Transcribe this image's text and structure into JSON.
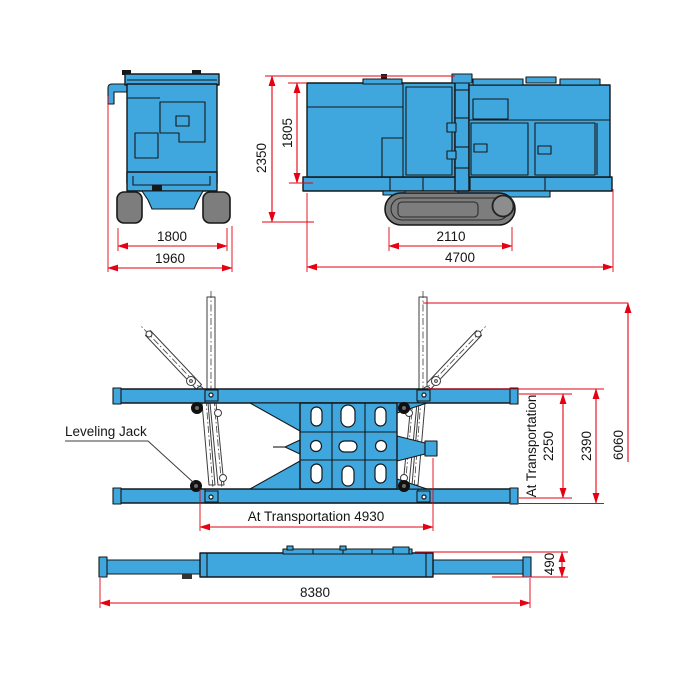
{
  "colors": {
    "machine_blue": "#3fa7dd",
    "track_gray": "#7d7d7d",
    "dim_red": "#e60012",
    "outline": "#16181a",
    "background": "#ffffff"
  },
  "front_view": {
    "dim_track_width": "1800",
    "dim_overall_width": "1960"
  },
  "side_view": {
    "dim_overall_height": "2350",
    "dim_body_height": "1805",
    "dim_track_length": "2110",
    "dim_overall_length": "4700"
  },
  "plan_view": {
    "leveling_jack_label": "Leveling Jack",
    "dim_transport_length": "At Transportation 4930",
    "dim_transport_width_line1": "At Transportation",
    "dim_transport_width_value": "2250",
    "dim_frame_width": "2390",
    "dim_outrigger_span": "6060"
  },
  "elevation_view": {
    "dim_overall_length": "8380",
    "dim_height": "490"
  }
}
